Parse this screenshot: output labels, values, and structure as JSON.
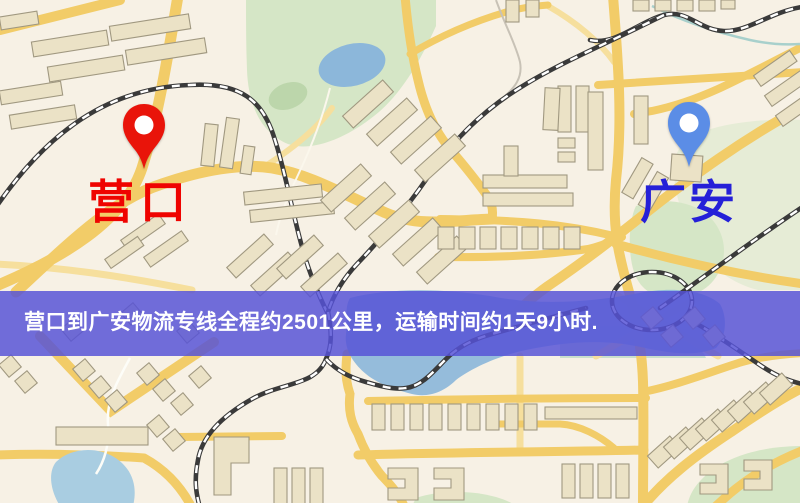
{
  "map": {
    "origin": {
      "label": "营口",
      "label_color": "#ef0300",
      "pin_color": "#e9140a"
    },
    "destination": {
      "label": "广安",
      "label_color": "#2520d8",
      "pin_color": "#5b8de6"
    },
    "banner": {
      "text": "营口到广安物流专线全程约2501公里，运输时间约1天9小时.",
      "background_color": "rgba(86,82,214,0.84)",
      "text_color": "#ffffff"
    },
    "palette": {
      "map_background": "#f7f1e5",
      "road": "#f2cc68",
      "minor_road": "#f6df9d",
      "building": "#ebe2c6",
      "park": "#d5e6c6",
      "water": "#8cb7da",
      "railway": "#3a3a3a"
    }
  }
}
